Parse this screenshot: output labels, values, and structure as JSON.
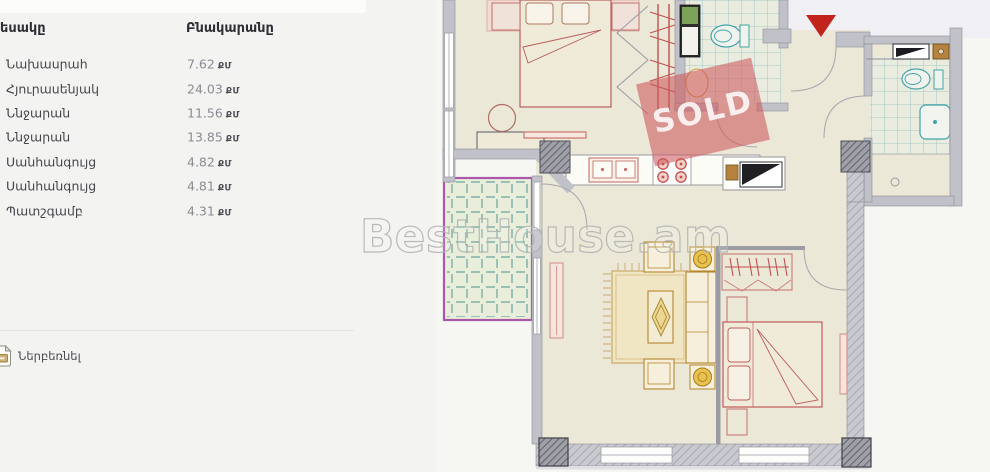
{
  "page": {
    "background": "#f3f3f1"
  },
  "table": {
    "headers": {
      "type": "Տեսակը",
      "apartment": "Բնակարանը"
    },
    "rows": [
      {
        "label": "Նախասրահ",
        "value": "7.62",
        "unit": "ՔՄ"
      },
      {
        "label": "Հյուրասենյակ",
        "value": "24.03",
        "unit": "ՔՄ"
      },
      {
        "label": "Ննջարան",
        "value": "11.56",
        "unit": "ՔՄ"
      },
      {
        "label": "Ննջարան",
        "value": "13.85",
        "unit": "ՔՄ"
      },
      {
        "label": "Սանհանգույց",
        "value": "4.82",
        "unit": "ՔՄ"
      },
      {
        "label": "Սանհանգույց",
        "value": "4.81",
        "unit": "ՔՄ"
      },
      {
        "label": "Պատշգամբ",
        "value": "4.31",
        "unit": "ՔՄ"
      }
    ]
  },
  "download": {
    "label": "Ներբեռնել",
    "icon": "file-download-icon"
  },
  "floorplan": {
    "watermark": "BestHouse.am",
    "sold_label": "SOLD",
    "colors": {
      "sold_stamp": "#cd585c",
      "entrance_marker": "#c2231d",
      "wall": "#c1c1c9",
      "tile_line": "#8fc0bf",
      "balcony_border": "#ab58ab",
      "furniture_red": "#c25b5b",
      "furniture_tan": "#b5862e",
      "floor": "#ebe8d7"
    }
  }
}
